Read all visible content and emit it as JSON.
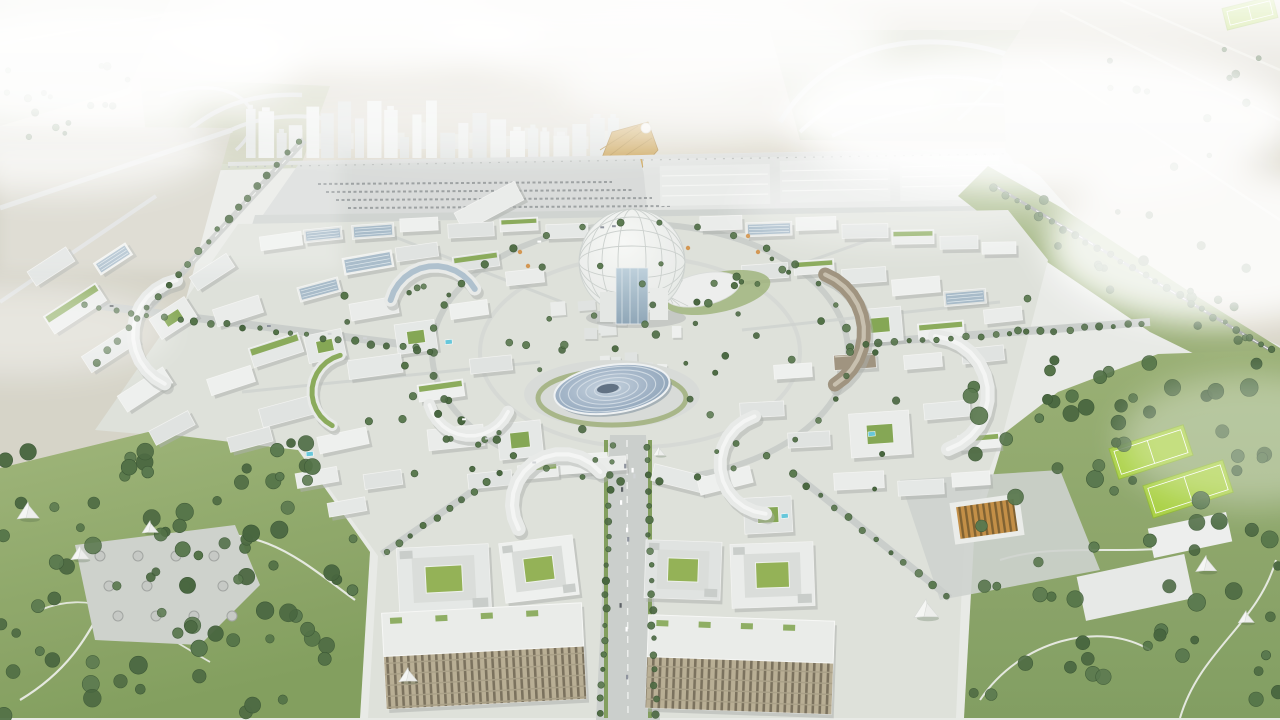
{
  "meta": {
    "description": "Aerial architectural rendering of a circular city masterplan with a central geodesic dome, pavilions, crescent-shaped mid-rise buildings, tree-lined avenues, parks and a distant high-rise skyline under white haze",
    "width": 1280,
    "height": 720
  },
  "landmarks": {
    "central_dome": "central geodesic dome pavilion",
    "disc_pavilion": "elliptical pavilion with concentric ring roof",
    "shell_pavilion": "white ribbed shell roof pavilion",
    "gold_pavilion": "golden wing-shaped pavilion",
    "exhibition_halls": "long flat exhibition halls and parking field",
    "skyline": "distant white high-rise skyline",
    "interchange_left": "highway interchange west",
    "interchange_right": "highway interchange east",
    "metro_line": "elevated road and metro line",
    "west_park": "west park with shade canopies and plaza",
    "east_park": "east park with sports pitches",
    "central_avenue": "tree-lined central avenue",
    "ring_road": "oval ring boulevard",
    "city_fabric": "rings of white mid-rise buildings",
    "foreground_blocks": "courtyard office blocks and balcony apartment blocks"
  },
  "palette": {
    "haze": "#f4f5f4",
    "desert_top": "#ddd9cc",
    "desert_right": "#d7d3c5",
    "desert_left": "#d4d2c6",
    "city_ground": "#dde0d9",
    "grass_light": "#93ab6c",
    "grass_dark": "#7d9a57",
    "pitch_green": "#a6cf3c",
    "tree_greens": [
      "#4a6b3e",
      "#3f5e35",
      "#527246",
      "#45643a"
    ],
    "building_whites": [
      "#e9ebe9",
      "#e4e7e5",
      "#eef0ee",
      "#dfe2e0"
    ],
    "building_shadow": "#a9ada9",
    "glass_blue": "#9db4c4",
    "disc_blue": "#8ea4ba",
    "bronze": "#9b8f7a",
    "gold": "#c99f4e",
    "roof_green": "#7fa34c",
    "road": "#c6c9c6",
    "pool_cyan": "#5fc4d8",
    "accent_orange": "#cf8a3a"
  },
  "scene": {
    "skyline": {
      "x0": 246,
      "x1": 612,
      "base": 158,
      "back_base": 149,
      "back_n": 14
    },
    "buildings": [
      [
        44,
        298,
        62,
        21,
        -33,
        3
      ],
      [
        82,
        340,
        56,
        19,
        -33,
        0
      ],
      [
        118,
        380,
        54,
        19,
        -33,
        0
      ],
      [
        28,
        258,
        46,
        17,
        -33,
        0
      ],
      [
        152,
        306,
        42,
        24,
        -33,
        2
      ],
      [
        190,
        264,
        44,
        16,
        -33,
        0
      ],
      [
        94,
        252,
        38,
        14,
        -33,
        1
      ],
      [
        150,
        420,
        44,
        16,
        -28,
        0
      ],
      [
        214,
        302,
        48,
        18,
        -18,
        0
      ],
      [
        250,
        340,
        52,
        20,
        -18,
        3
      ],
      [
        208,
        372,
        46,
        17,
        -18,
        0
      ],
      [
        260,
        402,
        54,
        19,
        -15,
        0
      ],
      [
        298,
        282,
        42,
        15,
        -15,
        1
      ],
      [
        306,
        332,
        38,
        28,
        -12,
        2
      ],
      [
        318,
        432,
        50,
        17,
        -12,
        0
      ],
      [
        228,
        432,
        44,
        15,
        -15,
        0
      ],
      [
        296,
        470,
        42,
        15,
        -10,
        0
      ],
      [
        328,
        500,
        38,
        14,
        -10,
        0
      ],
      [
        343,
        254,
        50,
        17,
        -10,
        1
      ],
      [
        396,
        245,
        42,
        14,
        -8,
        0
      ],
      [
        350,
        300,
        48,
        17,
        -10,
        0
      ],
      [
        396,
        322,
        40,
        30,
        -8,
        2
      ],
      [
        450,
        302,
        38,
        15,
        -8,
        0
      ],
      [
        453,
        254,
        46,
        15,
        -8,
        3
      ],
      [
        506,
        270,
        38,
        14,
        -6,
        0
      ],
      [
        348,
        357,
        54,
        19,
        -8,
        0
      ],
      [
        418,
        382,
        46,
        17,
        -8,
        3
      ],
      [
        470,
        357,
        42,
        15,
        -6,
        0
      ],
      [
        428,
        427,
        56,
        21,
        -6,
        0
      ],
      [
        498,
        422,
        44,
        36,
        -6,
        2
      ],
      [
        556,
        454,
        52,
        19,
        -4,
        0
      ],
      [
        364,
        472,
        38,
        15,
        -8,
        0
      ],
      [
        455,
        196,
        68,
        21,
        -28,
        0
      ],
      [
        352,
        224,
        42,
        14,
        -4,
        1
      ],
      [
        400,
        218,
        38,
        13,
        -3,
        0
      ],
      [
        448,
        223,
        46,
        14,
        -3,
        0
      ],
      [
        500,
        218,
        38,
        13,
        -3,
        3
      ],
      [
        546,
        224,
        42,
        14,
        -2,
        0
      ],
      [
        260,
        234,
        42,
        14,
        -8,
        0
      ],
      [
        304,
        228,
        38,
        13,
        -6,
        1
      ],
      [
        700,
        216,
        42,
        14,
        -2,
        0
      ],
      [
        746,
        222,
        46,
        14,
        -2,
        1
      ],
      [
        796,
        217,
        40,
        13,
        -2,
        0
      ],
      [
        842,
        224,
        46,
        14,
        -1,
        0
      ],
      [
        892,
        230,
        42,
        14,
        -1,
        3
      ],
      [
        940,
        236,
        38,
        13,
        -1,
        0
      ],
      [
        982,
        242,
        34,
        12,
        -1,
        0
      ],
      [
        742,
        264,
        46,
        15,
        -4,
        0
      ],
      [
        794,
        260,
        40,
        14,
        -4,
        3
      ],
      [
        842,
        268,
        44,
        15,
        -4,
        0
      ],
      [
        892,
        278,
        48,
        16,
        -5,
        0
      ],
      [
        944,
        290,
        42,
        15,
        -5,
        1
      ],
      [
        984,
        308,
        38,
        14,
        -6,
        0
      ],
      [
        858,
        308,
        44,
        34,
        -5,
        2
      ],
      [
        918,
        322,
        46,
        16,
        -5,
        3
      ],
      [
        962,
        347,
        42,
        15,
        -6,
        0
      ],
      [
        904,
        354,
        38,
        14,
        -5,
        0
      ],
      [
        834,
        354,
        42,
        15,
        -4,
        4
      ],
      [
        774,
        364,
        38,
        14,
        -4,
        0
      ],
      [
        740,
        402,
        44,
        15,
        -3,
        0
      ],
      [
        850,
        412,
        60,
        44,
        -4,
        2
      ],
      [
        924,
        402,
        46,
        16,
        -5,
        0
      ],
      [
        958,
        434,
        42,
        15,
        -5,
        3
      ],
      [
        788,
        432,
        42,
        15,
        -3,
        0
      ],
      [
        834,
        472,
        50,
        17,
        -3,
        0
      ],
      [
        898,
        480,
        46,
        15,
        -3,
        0
      ],
      [
        952,
        472,
        38,
        14,
        -4,
        0
      ],
      [
        468,
        472,
        44,
        15,
        -6,
        0
      ],
      [
        518,
        464,
        40,
        14,
        -5,
        3
      ],
      [
        652,
        470,
        54,
        17,
        14,
        0
      ],
      [
        698,
        472,
        54,
        17,
        -14,
        0
      ],
      [
        744,
        497,
        48,
        36,
        -3,
        2
      ],
      [
        588,
        457,
        38,
        14,
        -4,
        0
      ],
      [
        398,
        546,
        92,
        66,
        -3,
        5
      ],
      [
        502,
        539,
        74,
        60,
        -7,
        5
      ],
      [
        645,
        541,
        76,
        58,
        2,
        5
      ],
      [
        731,
        543,
        83,
        64,
        -2,
        5
      ],
      [
        384,
        608,
        200,
        96,
        -3,
        6
      ],
      [
        647,
        618,
        186,
        93,
        2,
        6
      ]
    ],
    "crescents": [
      [
        435,
        312,
        46,
        195,
        330,
        13,
        1
      ],
      [
        188,
        334,
        55,
        115,
        258,
        13,
        0
      ],
      [
        470,
        394,
        42,
        25,
        165,
        12,
        0
      ],
      [
        562,
        504,
        50,
        150,
        320,
        14,
        0
      ],
      [
        802,
        332,
        62,
        -68,
        58,
        14,
        4
      ],
      [
        930,
        394,
        58,
        -85,
        72,
        14,
        0
      ],
      [
        770,
        464,
        50,
        95,
        252,
        13,
        0
      ],
      [
        350,
        392,
        38,
        118,
        255,
        11,
        3
      ]
    ],
    "village": {
      "x": 546,
      "y": 300,
      "w": 148,
      "h": 84,
      "n": 16
    },
    "orange_accents": [
      [
        520,
        252
      ],
      [
        528,
        266
      ],
      [
        748,
        236
      ],
      [
        758,
        252
      ],
      [
        688,
        248
      ]
    ],
    "tree_regions": [
      [
        0,
        440,
        356,
        276,
        85,
        4,
        9
      ],
      [
        968,
        356,
        312,
        358,
        75,
        4,
        9
      ],
      [
        2,
        56,
        150,
        84,
        16,
        2,
        4
      ],
      [
        1000,
        196,
        276,
        150,
        20,
        3,
        5
      ],
      [
        1062,
        36,
        210,
        180,
        13,
        2,
        4
      ],
      [
        340,
        246,
        560,
        250,
        55,
        2,
        4
      ],
      [
        688,
        268,
        96,
        52,
        9,
        2,
        4
      ]
    ],
    "tree_lines": [
      [
        612,
        446,
        601,
        714,
        18
      ],
      [
        646,
        446,
        656,
        714,
        18
      ],
      [
        434,
        352,
        84,
        306,
        22
      ],
      [
        98,
        362,
        298,
        142,
        20
      ],
      [
        850,
        346,
        1142,
        324,
        20
      ],
      [
        500,
        474,
        386,
        552,
        9
      ],
      [
        792,
        474,
        946,
        596,
        11
      ],
      [
        994,
        188,
        1272,
        350,
        24
      ]
    ],
    "ring_trees": {
      "cx": 640,
      "cy": 352,
      "rx": 210,
      "ry": 130,
      "n": 34
    },
    "pitches": [
      [
        1112,
        436,
        78,
        32,
        -18
      ],
      [
        1146,
        472,
        84,
        34,
        -18
      ],
      [
        1224,
        2,
        52,
        22,
        -14
      ]
    ],
    "canopies": [
      [
        28,
        512,
        18
      ],
      [
        80,
        554,
        15
      ],
      [
        150,
        528,
        13
      ],
      [
        408,
        676,
        15
      ],
      [
        926,
        610,
        20
      ],
      [
        1206,
        565,
        17
      ],
      [
        1246,
        618,
        13
      ],
      [
        659,
        452,
        10
      ]
    ],
    "pools": [
      [
        306,
        452
      ],
      [
        868,
        432
      ],
      [
        781,
        514
      ],
      [
        445,
        340
      ]
    ],
    "plaza_pods": {
      "x0": 100,
      "y0": 556,
      "cols": 4,
      "rows": 3,
      "dx": 38,
      "dy": 30
    },
    "cars": {
      "avenue_n": 10,
      "ring_n": 6,
      "west_n": 4
    },
    "parking_rows": [
      [
        318,
        184,
        294
      ],
      [
        326,
        192,
        306
      ],
      [
        336,
        200,
        316
      ],
      [
        348,
        208,
        324
      ]
    ]
  }
}
